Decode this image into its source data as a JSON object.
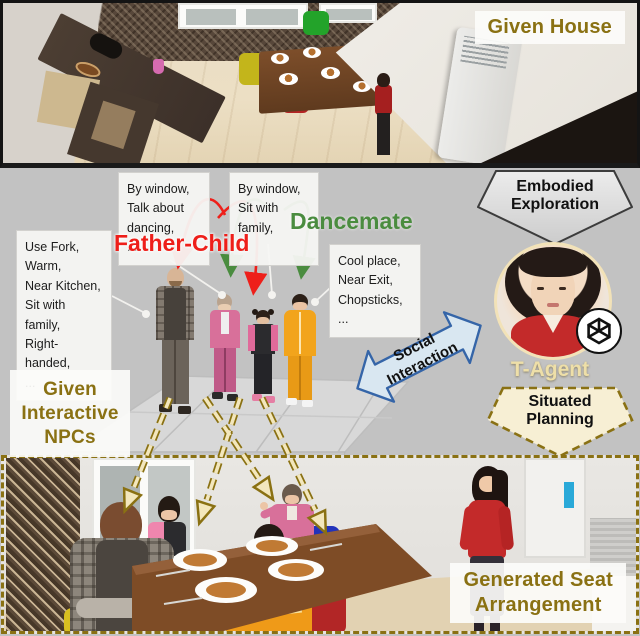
{
  "colors": {
    "accent_gold": "#8a7113",
    "father_child_red": "#ee1f1a",
    "dancemate_green": "#4a8c3f",
    "social_blue": "#3565a8",
    "arrow_cream": "#f3e7bd",
    "panel_grey": "#c2c2c2"
  },
  "top_panel": {
    "label": "Given House"
  },
  "middle": {
    "boxes": {
      "father": "Use Fork,\nWarm,\nNear Kitchen,\nSit with family,\nRight-handed,\n...",
      "mother": "By window,\nTalk about\ndancing,\n...",
      "child": "By window,\nSit with family,\n...",
      "kid": "Cool place,\nNear Exit,\nChopsticks,\n..."
    },
    "relationships": {
      "father_child": "Father-Child",
      "dancemate": "Dancemate"
    },
    "npcs_label": "Given\nInteractive\nNPCs",
    "embodied_exploration": "Embodied\nExploration",
    "social_interaction": "Social\nInteraction",
    "situated_planning": "Situated\nPlanning",
    "agent_name": "T-Agent"
  },
  "bottom_panel": {
    "label": "Generated Seat\nArrangement"
  },
  "icons": {
    "agent_badge": "openai-logo"
  }
}
